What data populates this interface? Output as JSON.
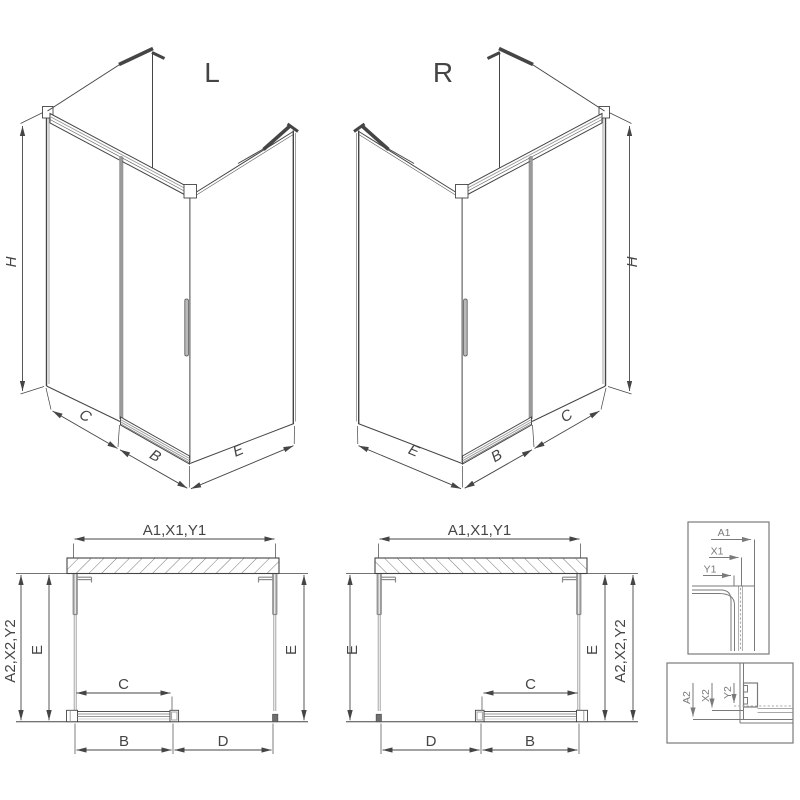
{
  "views": {
    "iso_left": {
      "label": "L",
      "dims": {
        "height": "H",
        "fixed_panel": "C",
        "door": "B",
        "side_panel": "E"
      }
    },
    "iso_right": {
      "label": "R",
      "dims": {
        "height": "H",
        "side_panel": "E",
        "door": "B",
        "fixed_panel": "C"
      }
    },
    "plan_left": {
      "dims": {
        "top": "A1,X1,Y1",
        "outer_side": "A2,X2,Y2",
        "inner_left": "E",
        "inner_right": "E",
        "door_travel": "C",
        "bottom_left": "B",
        "bottom_right": "D"
      }
    },
    "plan_right": {
      "dims": {
        "top": "A1,X1,Y1",
        "outer_side": "A2,X2,Y2",
        "inner_left": "E",
        "inner_right": "E",
        "door_travel": "C",
        "bottom_left": "D",
        "bottom_right": "B"
      }
    }
  },
  "details": {
    "top": {
      "dim_a": "A1",
      "dim_x": "X1",
      "dim_y": "Y1"
    },
    "bottom": {
      "dim_a": "A2",
      "dim_x": "X2",
      "dim_y": "Y2"
    }
  },
  "colors": {
    "background": "#ffffff",
    "line": "#454545",
    "soft": "#9a9a9a",
    "profile": "#8a8a8a",
    "detail": "#7a7a7a",
    "glass_core": "#a8a8a8",
    "hatch": "#6a6a6a"
  }
}
